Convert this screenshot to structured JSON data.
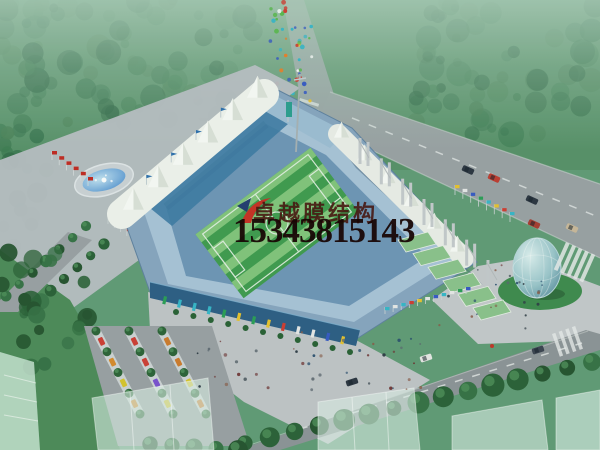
{
  "watermark": {
    "logo_icon": "red-brush-swoosh",
    "company_name": "卓越膜结构",
    "phone_number": "15343815143",
    "company_color": "#46150f",
    "phone_color": "#170403"
  },
  "palette": {
    "haze": "#aecdbb",
    "canopy_greens": [
      "#33704a",
      "#2a6240",
      "#3d7b51",
      "#487f55"
    ],
    "tree_greens": [
      "#2a5f36",
      "#357044",
      "#24522e"
    ],
    "lawn": "#4c8a58",
    "road": "#9aa1a4",
    "plaza": "#c1c4c8",
    "bowl_outer": "#87a5c0",
    "bowl_mid": "#a9c3d9",
    "bowl_inner": "#6e95b7",
    "deck_blue": "#3d7aa4",
    "membrane_white": "#f2f4ef",
    "pitch_green": "#3f9a4d",
    "pitch_stripe": "#8ecc84",
    "facade_blue": "#2c5c84",
    "water_blue": "#4f8fd0",
    "terrace_green": "#8cc28c",
    "egg_glass": "#79aebc",
    "flag_colors": [
      "#d03a30",
      "#3558c5",
      "#e8c22e",
      "#35b6c9",
      "#e8e8e8",
      "#2a9d55"
    ],
    "car_colors": [
      "#d98a2b",
      "#cf3b33",
      "#d9c42b",
      "#7a4fd0",
      "#3558c5",
      "#e8e8e8",
      "#cf7a2b"
    ],
    "crowd_colors": [
      "#d03a30",
      "#3558c5",
      "#e8c22e",
      "#35b6c9",
      "#ffffff",
      "#e87f2a",
      "#57b84a"
    ],
    "people_colors": [
      "#2e3a44",
      "#5a646e",
      "#8a5a48",
      "#274b6d",
      "#6d2f2f"
    ]
  },
  "scene": {
    "elements": [
      "misty-tree-canopy",
      "highway",
      "vertical-approach-road",
      "pedestrian-crowd",
      "fountain-pool",
      "tree-lined-avenue",
      "flag-rows",
      "membrane-stadium",
      "tent-roof-row",
      "steel-pylon-colonnade",
      "football-pitch",
      "grandstand-bowl",
      "entrance-facade",
      "terraced-green-steps",
      "pedestrian-plaza",
      "glass-egg-pavilion",
      "zebra-crossings",
      "parking-lot",
      "bottom-road",
      "street-tree-row",
      "translucent-buildings"
    ]
  }
}
